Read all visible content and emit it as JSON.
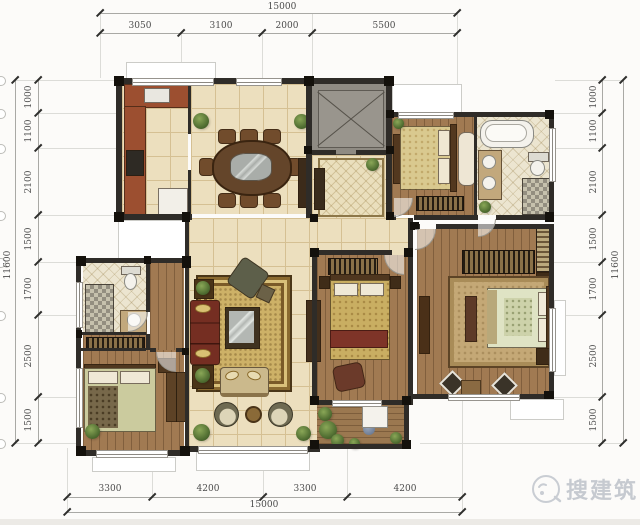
{
  "dimensions": {
    "top": {
      "total": "15000",
      "segments": [
        "3050",
        "3100",
        "2000",
        "5500"
      ]
    },
    "bottom": {
      "total": "15000",
      "segments": [
        "3300",
        "4200",
        "3300",
        "4200"
      ]
    },
    "left": {
      "total": "11600",
      "segments": [
        "1000",
        "1100",
        "2100",
        "1500",
        "1700",
        "2500",
        "1500"
      ]
    },
    "right": {
      "total": "11600",
      "segments": [
        "1000",
        "1100",
        "2100",
        "1500",
        "1700",
        "2500",
        "1500"
      ]
    }
  },
  "watermark": {
    "text": "搜建筑"
  },
  "colors": {
    "wall": "#2f2c28",
    "column": "#14110c",
    "tile": "#ecdfbe",
    "grout": "#d5c093",
    "wood": "#a17a52",
    "deck": "#9b7850",
    "bath_floor": "#ece5d0",
    "rug": "#cdb167",
    "sofa": "#752e22",
    "table_wood": "#64452a",
    "bedding": "#d9c98f",
    "bedding_master": "#dfe3c4",
    "elevator": "#8f8b83",
    "plant": "#4e6b30",
    "dim_text": "#4c4c4c",
    "dim_line": "#a9a9a5",
    "grid_line": "#dcdcd8",
    "bay_line": "#ccccc8",
    "watermark": "#c6cad0"
  }
}
